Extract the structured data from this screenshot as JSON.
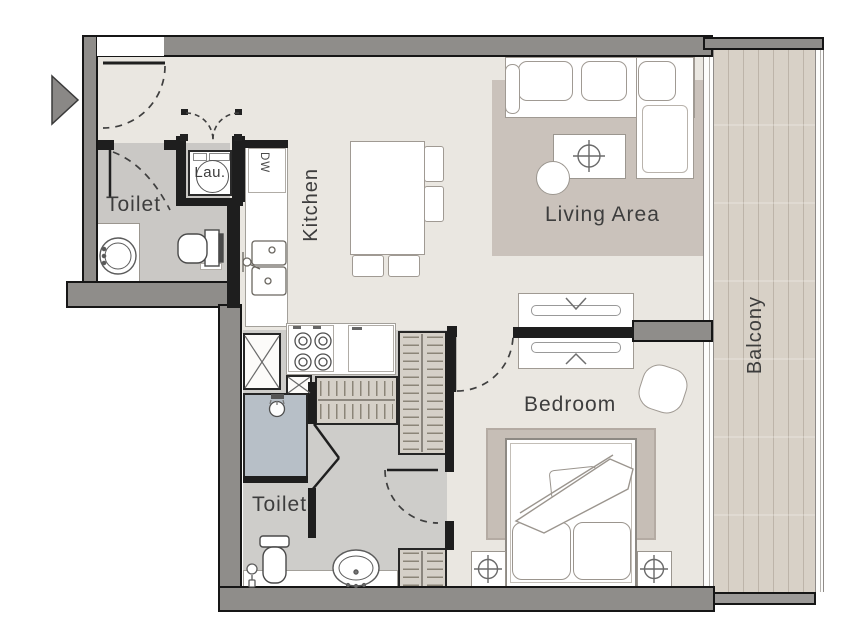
{
  "title": "Apartment floor plan",
  "rooms": {
    "toilet_top": {
      "label": "Toilet"
    },
    "laundry": {
      "label": "Lau."
    },
    "kitchen": {
      "label": "Kitchen"
    },
    "living": {
      "label": "Living Area"
    },
    "balcony": {
      "label": "Balcony"
    },
    "bedroom": {
      "label": "Bedroom"
    },
    "toilet_bottom": {
      "label": "Toilet"
    }
  },
  "appliances": {
    "dishwasher": "DW"
  },
  "icons": [
    "entry-arrow-icon",
    "washing-machine-icon",
    "stove-burners-icon",
    "shower-head-icon",
    "table-lamp-icon",
    "ceiling-lamp-icon",
    "shaft-cross-icon",
    "sink-basin-icon",
    "toilet-icon"
  ],
  "colors": {
    "wall": "#8f8d8a",
    "wall_outline": "#161616",
    "partition": "#1e1e1e",
    "floor": "#eae7e1",
    "floor_bath": "#cac8c5",
    "floor_hall": "#cecdca",
    "rug_living": "#cac2bb",
    "rug_bedroom": "#c6beb6",
    "balcony_wood": "#d8d1c7",
    "shower_floor": "#b7bfc7",
    "furniture_line": "#a09a93",
    "wardrobe_fill": "#d5d0c8",
    "label_text": "#3d3d3d"
  }
}
